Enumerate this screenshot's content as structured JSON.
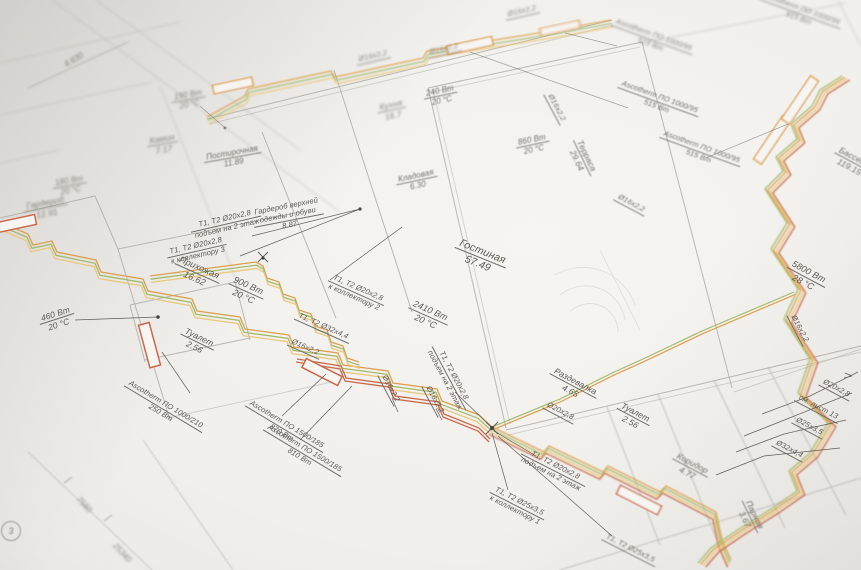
{
  "colors": {
    "paper": "#f1efeb",
    "wall": "#b0ada7",
    "leader": "#524f4a",
    "text": "#5c5953",
    "pipe_orange": "#dca04e",
    "pipe_yellow": "#e9c77d",
    "pipe_green": "#a3ba6b",
    "pipe_red": "#c96a4e"
  },
  "rooms": [
    {
      "name": "Гостиная",
      "area": "57.49",
      "x": 480,
      "y": 258,
      "rot": 22,
      "fs": 10.5
    },
    {
      "name": "Прихожая",
      "area": "16.62",
      "x": 197,
      "y": 273,
      "rot": 24,
      "fs": 9
    },
    {
      "name": "Туалет",
      "area": "2.56",
      "x": 197,
      "y": 342,
      "rot": 26,
      "fs": 8.5
    },
    {
      "name": "Гардероб",
      "area": "12.91",
      "x": 46,
      "y": 208,
      "rot": -10,
      "fs": 8.5,
      "bl": 2
    },
    {
      "name": "Камин",
      "area": "7.17",
      "x": 163,
      "y": 144,
      "rot": -10,
      "fs": 8.5,
      "bl": 2
    },
    {
      "name": "Постирочная",
      "area": "11.89",
      "x": 233,
      "y": 158,
      "rot": -10,
      "fs": 8,
      "bl": 1
    },
    {
      "name": "Кладовая",
      "area": "6.30",
      "x": 417,
      "y": 181,
      "rot": -12,
      "fs": 8,
      "bl": 1
    },
    {
      "name": "Гардероб верхней",
      "name2": "одежды и обуви",
      "area": "8.87",
      "x": 288,
      "y": 216,
      "rot": -11,
      "fs": 7.5
    },
    {
      "name": "Кухня",
      "area": "16.7",
      "x": 392,
      "y": 110,
      "rot": -12,
      "fs": 8.5,
      "bl": 2
    },
    {
      "name": "Терраса",
      "area": "29.64",
      "x": 582,
      "y": 158,
      "rot": 64,
      "fs": 8.5,
      "bl": 1
    },
    {
      "name": "Раздевалка",
      "area": "4.65",
      "x": 573,
      "y": 386,
      "rot": 28,
      "fs": 8.5
    },
    {
      "name": "Туалет",
      "area": "2.56",
      "x": 633,
      "y": 417,
      "rot": 28,
      "fs": 8.5
    },
    {
      "name": "Коридор",
      "area": "4.77",
      "x": 690,
      "y": 468,
      "rot": 28,
      "fs": 8.5,
      "bl": 1
    },
    {
      "name": "Парная",
      "area": "3.67",
      "x": 750,
      "y": 517,
      "rot": 64,
      "fs": 8.5,
      "bl": 1
    },
    {
      "name": "Бассейн",
      "area": "119.15",
      "x": 852,
      "y": 162,
      "rot": 28,
      "fs": 8.5,
      "bl": 1
    }
  ],
  "power_labels": [
    {
      "w": "2410 Вт",
      "t": "20 °С",
      "x": 428,
      "y": 316,
      "rot": 24,
      "fs": 9
    },
    {
      "w": "900 Вт",
      "t": "20 °С",
      "x": 246,
      "y": 291,
      "rot": 24,
      "fs": 9
    },
    {
      "w": "460 Вт",
      "t": "20 °С",
      "x": 57,
      "y": 319,
      "rot": -18,
      "fs": 8.5
    },
    {
      "w": "180 Вт",
      "t": "20 °С",
      "x": 70,
      "y": 186,
      "rot": -10,
      "fs": 8,
      "bl": 2
    },
    {
      "w": "190 Вт",
      "t": "20 °С",
      "x": 189,
      "y": 100,
      "rot": -10,
      "fs": 8,
      "bl": 2
    },
    {
      "w": "240 Вт",
      "t": "20 °С",
      "x": 441,
      "y": 96,
      "rot": -12,
      "fs": 8,
      "bl": 1
    },
    {
      "w": "860 Вт",
      "t": "20 °С",
      "x": 533,
      "y": 145,
      "rot": -12,
      "fs": 8,
      "bl": 1
    },
    {
      "w": "5800 Вт",
      "t": "28 °С",
      "x": 806,
      "y": 277,
      "rot": 28,
      "fs": 9
    }
  ],
  "pipe_labels": [
    {
      "l1": "Т1, Т2 Ø20х2,8",
      "l2": "подъем на 2 этаж",
      "x": 226,
      "y": 224,
      "rot": -13,
      "fs": 7.5
    },
    {
      "l1": "Т1, Т2 Ø20х2,8",
      "l2": "к коллектору 3",
      "x": 197,
      "y": 251,
      "rot": -13,
      "fs": 7.5
    },
    {
      "l1": "Т1, Т2 Ø20х2,8",
      "l2": "к коллектору 2",
      "x": 356,
      "y": 293,
      "rot": 24,
      "fs": 7.5
    },
    {
      "l1": "Т1, Т2 Ø32х4,4",
      "x": 323,
      "y": 327,
      "rot": 24,
      "fs": 7.5
    },
    {
      "l1": "Ø16х2,2",
      "x": 305,
      "y": 348,
      "rot": 24,
      "fs": 7.5
    },
    {
      "l1": "Ø16х2,2",
      "x": 373,
      "y": 57,
      "rot": -13,
      "fs": 7.5,
      "bl": 2
    },
    {
      "l1": "Ø16х2,2",
      "x": 444,
      "y": 50,
      "rot": -13,
      "fs": 7.5,
      "bl": 2
    },
    {
      "l1": "Ø16х2,2",
      "x": 522,
      "y": 12,
      "rot": -13,
      "fs": 7.5,
      "bl": 2
    },
    {
      "l1": "Ø16х2,2",
      "x": 556,
      "y": 108,
      "rot": 62,
      "fs": 7.5,
      "bl": 1
    },
    {
      "l1": "Ø16х2,2",
      "x": 631,
      "y": 204,
      "rot": 28,
      "fs": 7.5,
      "bl": 1
    },
    {
      "l1": "Ø16х2,2",
      "x": 799,
      "y": 329,
      "rot": 62,
      "fs": 7.5
    },
    {
      "l1": "Ø16х2,2",
      "x": 390,
      "y": 389,
      "rot": 62,
      "fs": 7.5
    },
    {
      "l1": "Ø16х2,2",
      "x": 434,
      "y": 400,
      "rot": 62,
      "fs": 7.5
    },
    {
      "l1": "Т1, Т2 Ø20х2,8",
      "l2": "подъем на 2 этаж",
      "x": 449,
      "y": 378,
      "rot": 62,
      "fs": 7.5
    },
    {
      "l1": "Т1, Т2 Ø20х2,8",
      "l2": "подъем на 2 этаж",
      "x": 553,
      "y": 470,
      "rot": 27,
      "fs": 7.5
    },
    {
      "l1": "Т1, Т2 Ø25х3,5",
      "l2": "к коллектору 1",
      "x": 517,
      "y": 506,
      "rot": 27,
      "fs": 7.5
    },
    {
      "l1": "Т1, Т2 Ø25х3,5",
      "x": 630,
      "y": 549,
      "rot": 27,
      "fs": 7.5,
      "bl": 1
    },
    {
      "l1": "Ø20х2,8",
      "x": 560,
      "y": 412,
      "rot": 28,
      "fs": 7.5
    },
    {
      "l1": "Ø20х2,8",
      "x": 836,
      "y": 389,
      "rot": 28,
      "fs": 7.5
    },
    {
      "l1": "см. лист 13",
      "x": 818,
      "y": 408,
      "rot": 28,
      "fs": 7.5
    },
    {
      "l1": "Ø25х3,5",
      "x": 809,
      "y": 427,
      "rot": 28,
      "fs": 7.5
    },
    {
      "l1": "Ø32х4,4",
      "x": 789,
      "y": 450,
      "rot": 28,
      "fs": 7.5
    }
  ],
  "equipment_labels": [
    {
      "m": "Ascotherm ПО 1000/210",
      "v": "250 Вт",
      "x": 163,
      "y": 409,
      "rot": 31,
      "fs": 7.5
    },
    {
      "m": "Ascotherm ПО 1500/185",
      "v": "870 Вт",
      "x": 284,
      "y": 429,
      "rot": 31,
      "fs": 7.5
    },
    {
      "m": "Ascotherm ПО 1500/185",
      "v": "810 Вт",
      "x": 302,
      "y": 453,
      "rot": 31,
      "fs": 7.5
    },
    {
      "m": "Ascotherm ПО 1000/95",
      "v": "515 Вт",
      "x": 652,
      "y": 40,
      "rot": 20,
      "fs": 7.5,
      "bl": 2
    },
    {
      "m": "Ascotherm ПО 1000/95",
      "v": "515 Вт",
      "x": 658,
      "y": 102,
      "rot": 20,
      "fs": 7.5,
      "bl": 1
    },
    {
      "m": "Ascotherm ПО 1000/95",
      "v": "515 Вт",
      "x": 700,
      "y": 152,
      "rot": 20,
      "fs": 7.5,
      "bl": 1
    },
    {
      "m": "Ascotherm ПО 1000/95",
      "v": "515 Вт",
      "x": 800,
      "y": 14,
      "rot": 20,
      "fs": 7.5,
      "bl": 2
    }
  ],
  "dimension_labels": [
    {
      "text": "7560",
      "x": 84,
      "y": 505,
      "rot": 47,
      "bl": 2
    },
    {
      "text": "25340",
      "x": 122,
      "y": 553,
      "rot": 47,
      "bl": 2
    },
    {
      "text": "4.630",
      "x": 74,
      "y": 60,
      "rot": -30,
      "bl": 2
    }
  ],
  "axis_marker": {
    "label": "3",
    "x": 11,
    "y": 531
  }
}
